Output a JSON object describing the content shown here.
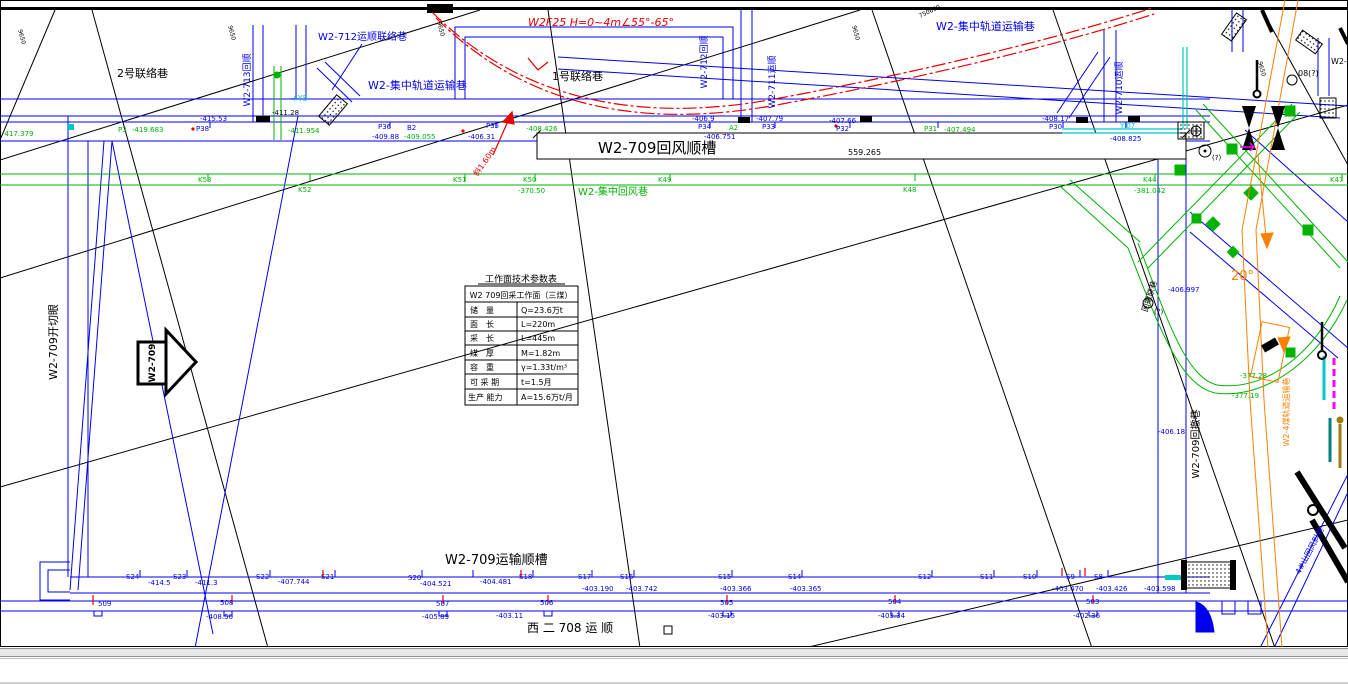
{
  "drawing": {
    "fault_label": "W2F25 H=0~4m∠55°-65°",
    "lianluoxiang_2": "2号联络巷",
    "lianluoxiang_1": "1号联络巷",
    "w2_712_yunshun_lianluoxiang": "W2-712运顺联络巷",
    "jizhong_guidao_left": "W2-集中轨道运输巷",
    "jizhong_guidao_right": "W2-集中轨道运输巷",
    "w2_709_huifeng_shuncao": "W2-709回风顺槽",
    "dim_length": "559.265",
    "jizhong_huifeng": "W2-集中回风巷",
    "w2_713_huishun": "W2-713回顺",
    "w2_712_huishun": "W2-712回顺",
    "w2_711_yunshun": "W2-711运顺",
    "w2_710_yunshun": "W2-710运顺",
    "w2_709_kaiqieyan": "W2-709开切眼",
    "advance_arrow": "W2-709",
    "w2_709_yunshu_shuncao": "W2-709运输顺槽",
    "xier_708_yunshun": "西 二 708 运 顺",
    "w2_709_huichexiang": "W2-709回撤巷",
    "huiche_lianxiang": "回撤联巷",
    "w2_4mei_guidao": "W2-4煤轨道运输巷",
    "sishan_huifeng_xiexiang": "4#山回风斜巷",
    "dip_20": "20°",
    "xie_160": "斜1.60m",
    "mark_08": "08(?)",
    "mark_q1": "(?)",
    "mark_q2": "(?)",
    "yj07": "YJ07",
    "y5": "+Y5",
    "w2_partial": "W2-",
    "b2": "B2",
    "a2": "A2"
  },
  "table": {
    "title": "工作面技术参数表",
    "header": "W2 709回采工作面（三煤）",
    "rows": [
      {
        "k": "储　量",
        "v": "Q=23.6万t"
      },
      {
        "k": "面　长",
        "v": "L=220m"
      },
      {
        "k": "采　长",
        "v": "L=445m"
      },
      {
        "k": "煤　厚",
        "v": "M=1.82m"
      },
      {
        "k": "容　重",
        "v": "γ=1.33t/m³"
      },
      {
        "k": "可 采 期",
        "v": "t=1.5月"
      },
      {
        "k": "生产 能力",
        "v": "A=15.6万t/月"
      }
    ]
  },
  "survey": {
    "p": [
      {
        "id": "",
        "val": "-417.379"
      },
      {
        "id": "P3",
        "val": "-419.683"
      },
      {
        "id": "P38",
        "val": "-415.53"
      },
      {
        "id": "",
        "val": "-411.28"
      },
      {
        "id": "",
        "val": "-411.954"
      },
      {
        "id": "P36",
        "val": "-409.88"
      },
      {
        "id": "",
        "val": "-409.055"
      },
      {
        "id": "P35",
        "val": "-406.31"
      },
      {
        "id": "",
        "val": "-408.426"
      },
      {
        "id": "P34",
        "val": "-406.9"
      },
      {
        "id": "",
        "val": "-406.751"
      },
      {
        "id": "P33",
        "val": "-407.79"
      },
      {
        "id": "P32",
        "val": "-407.66"
      },
      {
        "id": "P31",
        "val": "-407.494"
      },
      {
        "id": "P30",
        "val": "-408.17"
      },
      {
        "id": "",
        "val": "-408.825"
      }
    ],
    "k": [
      {
        "id": "K53",
        "val": ""
      },
      {
        "id": "K52",
        "val": ""
      },
      {
        "id": "K51",
        "val": ""
      },
      {
        "id": "K50",
        "val": "-370.50"
      },
      {
        "id": "K49",
        "val": ""
      },
      {
        "id": "K48",
        "val": ""
      },
      {
        "id": "K44",
        "val": "-381.042"
      },
      {
        "id": "K47",
        "val": ""
      }
    ],
    "s": [
      {
        "id": "S24",
        "val": "-414.5"
      },
      {
        "id": "S23",
        "val": "-411.3"
      },
      {
        "id": "S22",
        "val": "-407.744"
      },
      {
        "id": "S21",
        "val": ""
      },
      {
        "id": "S20",
        "val": "-404.521"
      },
      {
        "id": "S19",
        "val": "-404.481"
      },
      {
        "id": "S18",
        "val": ""
      },
      {
        "id": "S17",
        "val": "-403.190"
      },
      {
        "id": "S16",
        "val": "-403.742"
      },
      {
        "id": "S15",
        "val": "-403.366"
      },
      {
        "id": "S14",
        "val": "-403.365"
      },
      {
        "id": "S12",
        "val": ""
      },
      {
        "id": "S11",
        "val": ""
      },
      {
        "id": "S10",
        "val": ""
      },
      {
        "id": "S9",
        "val": "-403.470"
      },
      {
        "id": "S8",
        "val": "-403.426"
      },
      {
        "id": "",
        "val": "-403.598"
      }
    ],
    "c": [
      {
        "id": "509",
        "val": ""
      },
      {
        "id": "508",
        "val": "-408.50"
      },
      {
        "id": "507",
        "val": "-405.89"
      },
      {
        "id": "506",
        "val": "-403.11"
      },
      {
        "id": "505",
        "val": "-403.15"
      },
      {
        "id": "504",
        "val": "-403.34"
      },
      {
        "id": "503",
        "val": "-402.36"
      }
    ],
    "right_vals": [
      {
        "val": "-406.997"
      },
      {
        "val": "-406.18"
      },
      {
        "val": "-377.28"
      },
      {
        "val": "-377.19"
      }
    ],
    "grid_refs": [
      "9650",
      "9650",
      "9650",
      "9650",
      "750650",
      "9650"
    ]
  }
}
